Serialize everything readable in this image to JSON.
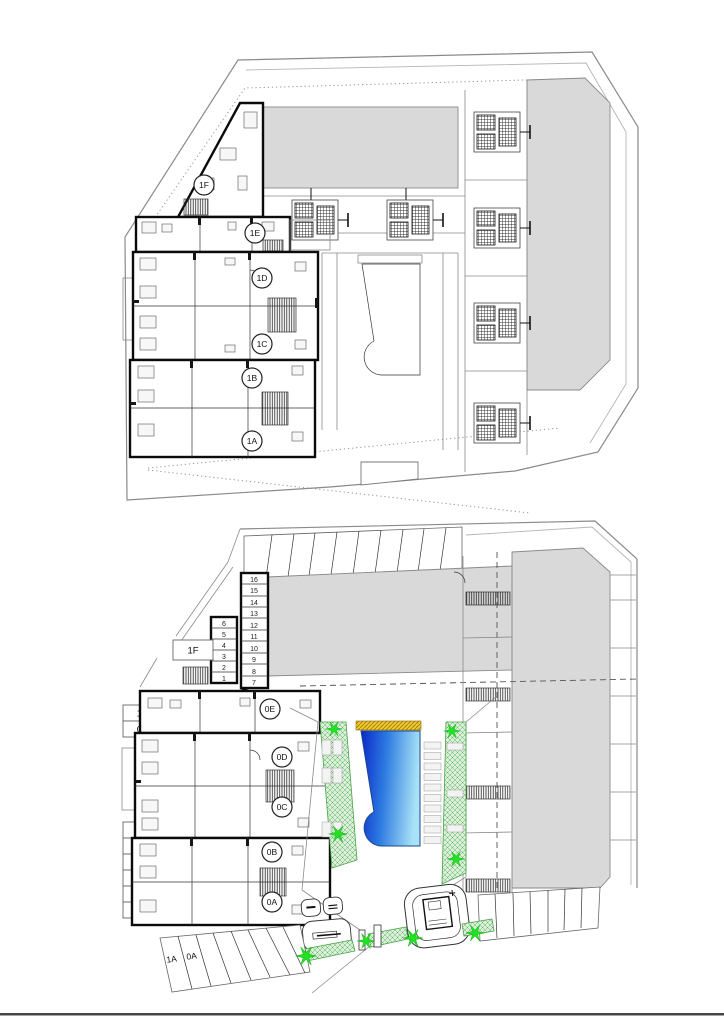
{
  "document": {
    "type": "architectural site plan",
    "sheets": [
      "first floor plan (top)",
      "ground floor plan with pool (bottom)"
    ]
  },
  "colors": {
    "building_fill": "#d9d9d9",
    "pool_deep": "#0a28c8",
    "pool_mid": "#2e7ce2",
    "pool_light": "#a9e2f6",
    "tree_green": "#22e022",
    "landscape_fill": "#ddefdc",
    "landscape_line": "#57b857",
    "deck_yellow": "#eec72e"
  },
  "upper_plan": {
    "unit_circles": [
      "1F",
      "1E",
      "1D",
      "1C",
      "1B",
      "1A"
    ]
  },
  "lower_plan": {
    "unit_circles": [
      "0E",
      "0D",
      "0C",
      "0B",
      "0A"
    ],
    "floor_tag": "1F",
    "left_boxes": [
      "1E",
      "0E",
      "1D",
      "0D",
      "1C",
      "0C",
      "1B",
      "0B"
    ],
    "storage_right": [
      "16",
      "15",
      "14",
      "13",
      "12",
      "11",
      "10",
      "9",
      "8",
      "7"
    ],
    "storage_left": [
      "6",
      "5",
      "4",
      "3",
      "2",
      "1"
    ],
    "parking_stall_labels": [
      "1A",
      "0A"
    ]
  }
}
